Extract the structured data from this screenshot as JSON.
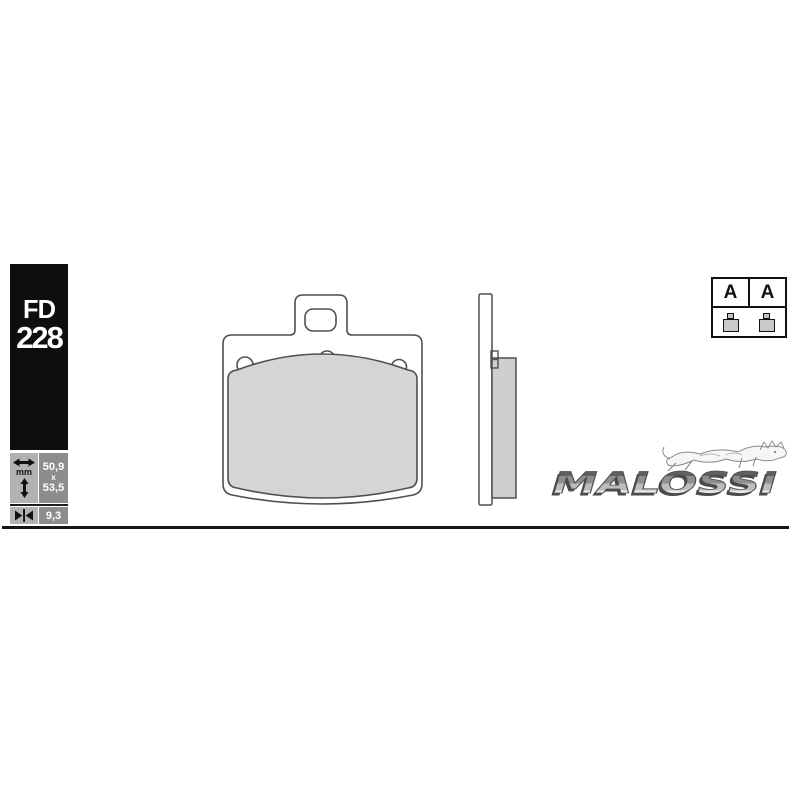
{
  "product_label": {
    "line1": "FD",
    "line2": "228"
  },
  "specs": {
    "unit": "mm",
    "width_mm": "50,9",
    "separator": "x",
    "height_mm": "53,5",
    "thickness_mm": "9,3"
  },
  "grade_box": {
    "left_letter": "A",
    "right_letter": "A"
  },
  "brand": {
    "name": "MALOSSI"
  },
  "icons": {
    "width_icon": "horizontal-double-arrow",
    "height_icon": "vertical-double-arrow",
    "thickness_icon": "inward-pointing-arrows",
    "brand_mark_icon": "leaping-lion",
    "grade_item_icon": "mini-brake-pad"
  },
  "colors": {
    "label_bg": "#0e0e0e",
    "cell_light": "#b2b2b2",
    "cell_dark": "#8d8d8d",
    "pad_fill": "#d5d5d5",
    "outline": "#4f4f4f",
    "rule": "#161616"
  }
}
